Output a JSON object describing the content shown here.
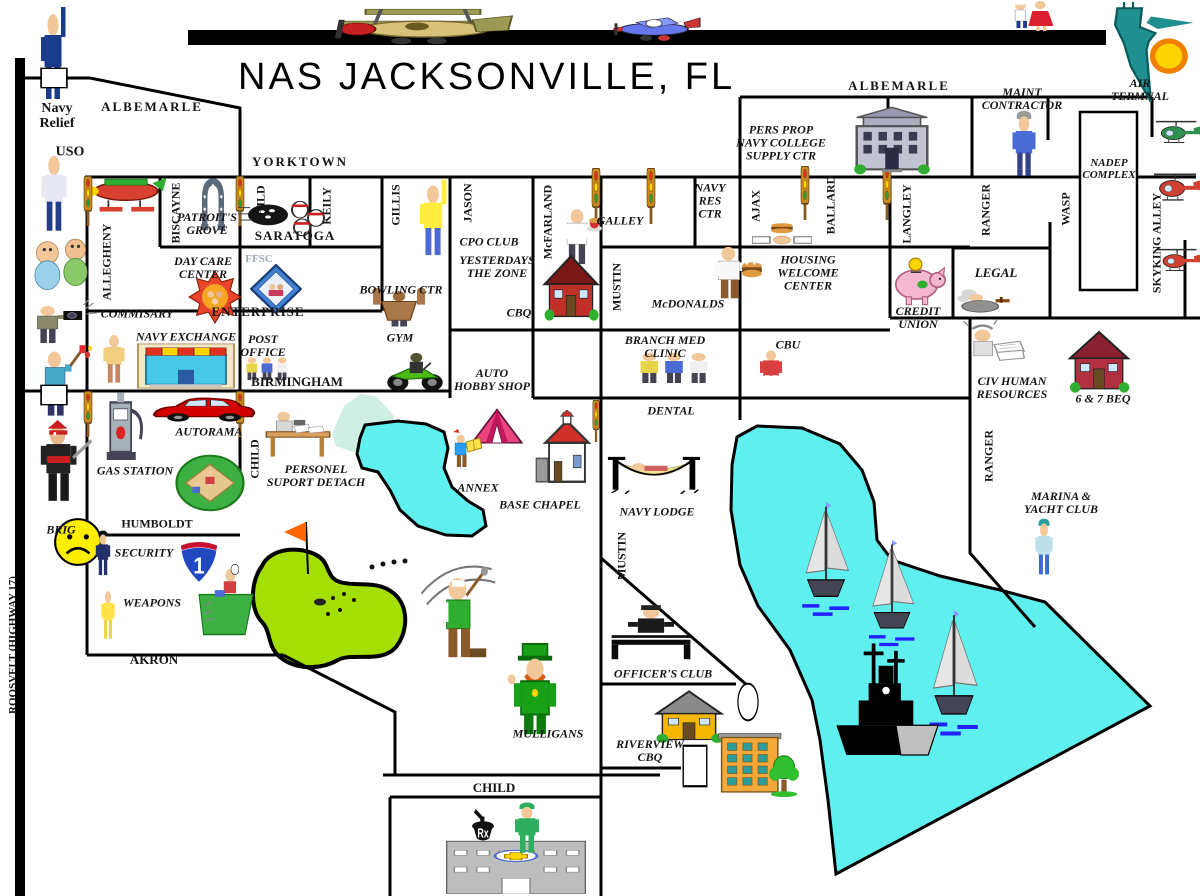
{
  "title": "NAS JACKSONVILLE, FL",
  "colors": {
    "water": "#5fefef",
    "water_sketch": "#cfeee4",
    "golf_green": "#a4de02",
    "flag": "#ff6600",
    "road": "#000000"
  },
  "interstate_shield": "1",
  "pharmacy_sign": "Rx",
  "labels": [
    {
      "id": "navy-relief",
      "t": "Navy\nRelief",
      "x": 57,
      "y": 116,
      "s": 14
    },
    {
      "id": "uso",
      "t": "USO",
      "x": 70,
      "y": 152,
      "s": 14
    },
    {
      "id": "albemarle-left",
      "t": "ALBEMARLE",
      "x": 152,
      "y": 107,
      "s": 13,
      "sp": 2
    },
    {
      "id": "yorktown",
      "t": "YORKTOWN",
      "x": 300,
      "y": 162,
      "s": 13,
      "sp": 2
    },
    {
      "id": "albemarle-right",
      "t": "ALBEMARLE",
      "x": 899,
      "y": 86,
      "s": 13,
      "sp": 2
    },
    {
      "id": "maint-contractor",
      "t": "MAINT\nCONTRACTOR",
      "x": 1022,
      "y": 99,
      "i": 1,
      "s": 12
    },
    {
      "id": "air-termnal",
      "t": "AIR TERMNAL",
      "x": 1140,
      "y": 90,
      "i": 1,
      "s": 12
    },
    {
      "id": "pers-prop",
      "t": "PERS PROP\nNAVY COLLEGE\nSUPPLY CTR",
      "x": 781,
      "y": 143,
      "i": 1,
      "s": 12
    },
    {
      "id": "navy-res-ctr",
      "t": "NAVY\nRES\nCTR",
      "x": 710,
      "y": 201,
      "i": 1,
      "s": 12
    },
    {
      "id": "nadep-complex",
      "t": "NADEP\nCOMPLEX",
      "x": 1109,
      "y": 170,
      "i": 1,
      "s": 11
    },
    {
      "id": "patriots-grove",
      "t": "PATROIT'S\nGROVE",
      "x": 207,
      "y": 224,
      "i": 1,
      "s": 12
    },
    {
      "id": "saratoga",
      "t": "SARATOGA",
      "x": 295,
      "y": 236,
      "s": 13,
      "sp": 1
    },
    {
      "id": "galley",
      "t": "GALLEY",
      "x": 620,
      "y": 221,
      "i": 1,
      "s": 12
    },
    {
      "id": "cpo-club",
      "t": "CPO CLUB",
      "x": 489,
      "y": 242,
      "i": 1,
      "s": 12
    },
    {
      "id": "yesterdays",
      "t": "YESTERDAYS\nTHE ZONE",
      "x": 497,
      "y": 267,
      "i": 1,
      "s": 12
    },
    {
      "id": "day-care",
      "t": "DAY CARE\nCENTER",
      "x": 203,
      "y": 268,
      "i": 1,
      "s": 12
    },
    {
      "id": "ffsc",
      "t": "FFSC",
      "x": 259,
      "y": 260,
      "s": 11,
      "c": "#9aa8b8"
    },
    {
      "id": "enterprise",
      "t": "ENTERPRISE",
      "x": 258,
      "y": 312,
      "s": 13,
      "sp": 1
    },
    {
      "id": "bowling-ctr",
      "t": "BOWLING CTR",
      "x": 401,
      "y": 290,
      "i": 1,
      "s": 12
    },
    {
      "id": "commisary",
      "t": "COMMISARY",
      "x": 137,
      "y": 314,
      "i": 1,
      "s": 12
    },
    {
      "id": "navy-exchange",
      "t": "NAVY EXCHANGE",
      "x": 186,
      "y": 337,
      "i": 1,
      "s": 12
    },
    {
      "id": "post-office",
      "t": "POST\nOFFICE",
      "x": 263,
      "y": 346,
      "i": 1,
      "s": 12
    },
    {
      "id": "birmingham",
      "t": "BIRMINGHAM",
      "x": 297,
      "y": 382,
      "s": 13
    },
    {
      "id": "gym",
      "t": "GYM",
      "x": 400,
      "y": 338,
      "i": 1,
      "s": 12
    },
    {
      "id": "auto-hobby",
      "t": "AUTO\nHOBBY SHOP",
      "x": 492,
      "y": 380,
      "i": 1,
      "s": 12
    },
    {
      "id": "cbq",
      "t": "CBQ",
      "x": 519,
      "y": 313,
      "i": 1,
      "s": 12
    },
    {
      "id": "mcdonalds",
      "t": "McDONALDS",
      "x": 688,
      "y": 304,
      "i": 1,
      "s": 12
    },
    {
      "id": "housing-welcome",
      "t": "HOUSING\nWELCOME\nCENTER",
      "x": 808,
      "y": 273,
      "i": 1,
      "s": 12
    },
    {
      "id": "credit-union",
      "t": "CREDIT\nUNION",
      "x": 918,
      "y": 318,
      "i": 1,
      "s": 12
    },
    {
      "id": "legal",
      "t": "LEGAL",
      "x": 996,
      "y": 273,
      "i": 1,
      "s": 13
    },
    {
      "id": "branch-med",
      "t": "BRANCH MED\nCLINIC",
      "x": 665,
      "y": 347,
      "i": 1,
      "s": 12
    },
    {
      "id": "cbu",
      "t": "CBU",
      "x": 788,
      "y": 345,
      "i": 1,
      "s": 12
    },
    {
      "id": "dental",
      "t": "DENTAL",
      "x": 671,
      "y": 411,
      "i": 1,
      "s": 12
    },
    {
      "id": "civ-hr",
      "t": "CIV  HUMAN\nRESOURCES",
      "x": 1012,
      "y": 388,
      "i": 1,
      "s": 12
    },
    {
      "id": "beq",
      "t": "6 & 7 BEQ",
      "x": 1103,
      "y": 399,
      "i": 1,
      "s": 12
    },
    {
      "id": "autorama",
      "t": "AUTORAMA",
      "x": 209,
      "y": 432,
      "i": 1,
      "s": 12
    },
    {
      "id": "gas-station",
      "t": "GAS STATION",
      "x": 135,
      "y": 471,
      "i": 1,
      "s": 12
    },
    {
      "id": "humboldt",
      "t": "HUMBOLDT",
      "x": 157,
      "y": 524,
      "s": 12
    },
    {
      "id": "brig",
      "t": "BRIG",
      "x": 61,
      "y": 530,
      "i": 1,
      "s": 12
    },
    {
      "id": "security",
      "t": "SECURITY",
      "x": 144,
      "y": 553,
      "i": 1,
      "s": 12
    },
    {
      "id": "weapons",
      "t": "WEAPONS",
      "x": 152,
      "y": 603,
      "i": 1,
      "s": 12
    },
    {
      "id": "akron",
      "t": "AKRON",
      "x": 154,
      "y": 660,
      "s": 13
    },
    {
      "id": "personel",
      "t": "PERSONEL\nSUPORT DETACH",
      "x": 316,
      "y": 476,
      "i": 1,
      "s": 12
    },
    {
      "id": "annex",
      "t": "ANNEX",
      "x": 478,
      "y": 488,
      "i": 1,
      "s": 12
    },
    {
      "id": "base-chapel",
      "t": "BASE CHAPEL",
      "x": 540,
      "y": 505,
      "i": 1,
      "s": 12
    },
    {
      "id": "navy-lodge",
      "t": "NAVY LODGE",
      "x": 657,
      "y": 512,
      "i": 1,
      "s": 12
    },
    {
      "id": "marina",
      "t": "MARINA &\nYACHT CLUB",
      "x": 1061,
      "y": 503,
      "i": 1,
      "s": 12
    },
    {
      "id": "officers-club",
      "t": "OFFICER'S CLUB",
      "x": 663,
      "y": 674,
      "i": 1,
      "s": 12
    },
    {
      "id": "mulligans",
      "t": "MULLIGANS",
      "x": 548,
      "y": 734,
      "i": 1,
      "s": 12
    },
    {
      "id": "riverview",
      "t": "RIVERVIEW\nCBQ",
      "x": 650,
      "y": 751,
      "i": 1,
      "s": 12
    },
    {
      "id": "child-bottom",
      "t": "CHILD",
      "x": 494,
      "y": 788,
      "s": 13
    },
    {
      "id": "allegheny",
      "t": "ALLEGHENY",
      "x": 107,
      "y": 262,
      "v": 1,
      "s": 12
    },
    {
      "id": "biscayne",
      "t": "BISCAYNE",
      "x": 176,
      "y": 213,
      "v": 1,
      "s": 12
    },
    {
      "id": "child-top",
      "t": "CHILD",
      "x": 261,
      "y": 205,
      "v": 1,
      "s": 12
    },
    {
      "id": "keily",
      "t": "KEILY",
      "x": 327,
      "y": 206,
      "v": 1,
      "s": 12
    },
    {
      "id": "gillis",
      "t": "GILLIS",
      "x": 396,
      "y": 205,
      "v": 1,
      "s": 12
    },
    {
      "id": "jason",
      "t": "JASON",
      "x": 468,
      "y": 203,
      "v": 1,
      "s": 12
    },
    {
      "id": "mcfarland",
      "t": "McFARLAND",
      "x": 548,
      "y": 222,
      "v": 1,
      "s": 12
    },
    {
      "id": "mustin-1",
      "t": "MUSTIN",
      "x": 617,
      "y": 287,
      "v": 1,
      "s": 12
    },
    {
      "id": "ajax",
      "t": "AJAX",
      "x": 756,
      "y": 206,
      "v": 1,
      "s": 12
    },
    {
      "id": "ballard",
      "t": "BALLARD",
      "x": 831,
      "y": 205,
      "v": 1,
      "s": 12
    },
    {
      "id": "langley",
      "t": "LANGLEY",
      "x": 907,
      "y": 214,
      "v": 1,
      "s": 12
    },
    {
      "id": "ranger-1",
      "t": "RANGER",
      "x": 986,
      "y": 210,
      "v": 1,
      "s": 12
    },
    {
      "id": "wasp",
      "t": "WASP",
      "x": 1066,
      "y": 209,
      "v": 1,
      "s": 12
    },
    {
      "id": "skyking-alley",
      "t": "SKYKING ALLEY",
      "x": 1157,
      "y": 243,
      "v": 1,
      "s": 12
    },
    {
      "id": "child-mid",
      "t": "CHILD",
      "x": 255,
      "y": 459,
      "v": 1,
      "s": 12
    },
    {
      "id": "mustin-2",
      "t": "MUSTIN",
      "x": 622,
      "y": 556,
      "v": 1,
      "s": 12
    },
    {
      "id": "ranger-2",
      "t": "RANGER",
      "x": 989,
      "y": 456,
      "v": 1,
      "s": 12
    },
    {
      "id": "roosevelt-hwy",
      "t": "ROOSVELT (HIGHWAY 17)",
      "x": 14,
      "y": 645,
      "v": 1,
      "s": 11
    }
  ],
  "icons": [
    {
      "id": "navy-officer",
      "k": "person",
      "x": 28,
      "y": 5,
      "w": 50,
      "h": 100,
      "o": {
        "shirt": "#1a3a8a",
        "pants": "#1a3a8a",
        "hat": "#ffffff",
        "arm": "up"
      }
    },
    {
      "id": "biplane",
      "k": "biplane",
      "x": 322,
      "y": 0,
      "w": 198,
      "h": 66
    },
    {
      "id": "blue-plane",
      "k": "monoplane",
      "x": 606,
      "y": 4,
      "w": 100,
      "h": 46
    },
    {
      "id": "sailor-couple",
      "k": "couple",
      "x": 998,
      "y": 0,
      "w": 66,
      "h": 50
    },
    {
      "id": "aircraft-carrier",
      "k": "carrier",
      "x": 1086,
      "y": 2,
      "w": 112,
      "h": 104
    },
    {
      "id": "uso-sailor",
      "k": "person",
      "x": 28,
      "y": 148,
      "w": 52,
      "h": 88,
      "o": {
        "shirt": "#e8e8f4",
        "pants": "#22408a",
        "hat": "#ffffff"
      }
    },
    {
      "id": "seaplane",
      "k": "seaplane",
      "x": 82,
      "y": 166,
      "w": 88,
      "h": 66
    },
    {
      "id": "babies",
      "k": "babies",
      "x": 24,
      "y": 224,
      "w": 78,
      "h": 80
    },
    {
      "id": "photographer",
      "k": "photographer",
      "x": 26,
      "y": 298,
      "w": 72,
      "h": 50
    },
    {
      "id": "painter",
      "k": "painter",
      "x": 28,
      "y": 342,
      "w": 66,
      "h": 80
    },
    {
      "id": "pirate",
      "k": "pirate",
      "x": 24,
      "y": 420,
      "w": 70,
      "h": 86
    },
    {
      "id": "brig-sad-face",
      "k": "sadface",
      "x": 52,
      "y": 516,
      "w": 52,
      "h": 52
    },
    {
      "id": "gate-north",
      "k": "gate",
      "x": 40,
      "y": 67,
      "w": 28,
      "h": 22
    },
    {
      "id": "gate-south",
      "k": "gate",
      "x": 40,
      "y": 384,
      "w": 28,
      "h": 22
    },
    {
      "id": "traffic-light-1",
      "k": "trafficlight",
      "x": 78,
      "y": 176,
      "w": 20,
      "h": 50
    },
    {
      "id": "traffic-light-2",
      "k": "trafficlight",
      "x": 230,
      "y": 176,
      "w": 20,
      "h": 50
    },
    {
      "id": "traffic-light-3",
      "k": "trafficlight",
      "x": 586,
      "y": 168,
      "w": 20,
      "h": 56
    },
    {
      "id": "traffic-light-4",
      "k": "trafficlight",
      "x": 641,
      "y": 168,
      "w": 20,
      "h": 56
    },
    {
      "id": "traffic-light-5",
      "k": "trafficlight",
      "x": 795,
      "y": 166,
      "w": 20,
      "h": 54
    },
    {
      "id": "traffic-light-6",
      "k": "trafficlight",
      "x": 877,
      "y": 166,
      "w": 20,
      "h": 54
    },
    {
      "id": "traffic-light-7",
      "k": "trafficlight",
      "x": 78,
      "y": 391,
      "w": 20,
      "h": 46
    },
    {
      "id": "traffic-light-8",
      "k": "trafficlight",
      "x": 230,
      "y": 391,
      "w": 20,
      "h": 46
    },
    {
      "id": "traffic-light-9",
      "k": "trafficlight",
      "x": 588,
      "y": 400,
      "w": 16,
      "h": 42
    },
    {
      "id": "horseshoe",
      "k": "horseshoe",
      "x": 190,
      "y": 172,
      "w": 46,
      "h": 62
    },
    {
      "id": "daycare-kids",
      "k": "starburst",
      "x": 188,
      "y": 270,
      "w": 54,
      "h": 54
    },
    {
      "id": "ffsc-sign",
      "k": "diamond",
      "x": 250,
      "y": 264,
      "w": 52,
      "h": 50
    },
    {
      "id": "commissary-shopper",
      "k": "person",
      "x": 92,
      "y": 330,
      "w": 44,
      "h": 56,
      "o": {
        "shirt": "#f0d080",
        "pants": "#c88660"
      }
    },
    {
      "id": "navy-exchange-store",
      "k": "store",
      "x": 136,
      "y": 342,
      "w": 100,
      "h": 48
    },
    {
      "id": "post-office-customers",
      "k": "docs",
      "x": 240,
      "y": 352,
      "w": 54,
      "h": 38
    },
    {
      "id": "bowling-ball-pins",
      "k": "bowling",
      "x": 238,
      "y": 192,
      "w": 100,
      "h": 52
    },
    {
      "id": "horseshoe-player",
      "k": "person",
      "x": 406,
      "y": 178,
      "w": 54,
      "h": 82,
      "o": {
        "shirt": "#ffec40",
        "pants": "#4a6ad4",
        "arm": "up"
      }
    },
    {
      "id": "gym-muscleman",
      "k": "muscleman",
      "x": 368,
      "y": 288,
      "w": 62,
      "h": 52
    },
    {
      "id": "motorcycle",
      "k": "motorcycle",
      "x": 382,
      "y": 344,
      "w": 66,
      "h": 52
    },
    {
      "id": "galley-chef",
      "k": "chef",
      "x": 548,
      "y": 202,
      "w": 58,
      "h": 66
    },
    {
      "id": "cbq-house",
      "k": "house",
      "x": 541,
      "y": 252,
      "w": 60,
      "h": 70,
      "o": {
        "body": "#c03028",
        "roof": "#7a1818"
      }
    },
    {
      "id": "mcdonalds-diner",
      "k": "eater",
      "x": 706,
      "y": 240,
      "w": 62,
      "h": 62
    },
    {
      "id": "welcome-handshake",
      "k": "handshake",
      "x": 752,
      "y": 220,
      "w": 60,
      "h": 40
    },
    {
      "id": "credit-union-piggy",
      "k": "piggy",
      "x": 890,
      "y": 252,
      "w": 58,
      "h": 56
    },
    {
      "id": "legal-judge",
      "k": "judge",
      "x": 948,
      "y": 284,
      "w": 70,
      "h": 36
    },
    {
      "id": "hr-thinker",
      "k": "thinker",
      "x": 958,
      "y": 320,
      "w": 72,
      "h": 56
    },
    {
      "id": "beq-house",
      "k": "house",
      "x": 1066,
      "y": 328,
      "w": 66,
      "h": 66,
      "o": {
        "body": "#b03040",
        "roof": "#8a2030"
      }
    },
    {
      "id": "college-building",
      "k": "college",
      "x": 850,
      "y": 106,
      "w": 84,
      "h": 72
    },
    {
      "id": "maint-worker",
      "k": "person",
      "x": 1000,
      "y": 110,
      "w": 48,
      "h": 70,
      "o": {
        "shirt": "#4a6ad4",
        "pants": "#33408a",
        "hat": "#999999"
      }
    },
    {
      "id": "helicopter-1",
      "k": "heli",
      "x": 1154,
      "y": 118,
      "w": 46,
      "h": 36,
      "o": {
        "c": "#2f8f4f"
      }
    },
    {
      "id": "helicopter-2",
      "k": "heli",
      "x": 1152,
      "y": 170,
      "w": 48,
      "h": 44,
      "o": {
        "c": "#d04030"
      }
    },
    {
      "id": "helicopter-3",
      "k": "heli",
      "x": 1156,
      "y": 246,
      "w": 44,
      "h": 36,
      "o": {
        "c": "#d04030"
      }
    },
    {
      "id": "autorama-car",
      "k": "car",
      "x": 150,
      "y": 388,
      "w": 108,
      "h": 42
    },
    {
      "id": "gas-pump",
      "k": "gaspump",
      "x": 94,
      "y": 388,
      "w": 58,
      "h": 80
    },
    {
      "id": "ballfield",
      "k": "ballfield",
      "x": 172,
      "y": 452,
      "w": 76,
      "h": 62
    },
    {
      "id": "security-policeman",
      "k": "person",
      "x": 88,
      "y": 530,
      "w": 30,
      "h": 48,
      "o": {
        "shirt": "#22306a",
        "pants": "#22306a",
        "hat": "#111111"
      }
    },
    {
      "id": "weapons-guard",
      "k": "person",
      "x": 94,
      "y": 586,
      "w": 28,
      "h": 56,
      "o": {
        "shirt": "#ffe24a",
        "pants": "#e8d44a"
      }
    },
    {
      "id": "interstate-shield",
      "k": "shield",
      "x": 176,
      "y": 534,
      "w": 46,
      "h": 52,
      "t": "1"
    },
    {
      "id": "ballfield-slider",
      "k": "slider",
      "x": 198,
      "y": 562,
      "w": 56,
      "h": 74
    },
    {
      "id": "personnel-clerk",
      "k": "desk",
      "x": 262,
      "y": 408,
      "w": 72,
      "h": 54
    },
    {
      "id": "annex-tent",
      "k": "tent",
      "x": 466,
      "y": 406,
      "w": 62,
      "h": 46
    },
    {
      "id": "annex-camper",
      "k": "reader",
      "x": 444,
      "y": 428,
      "w": 46,
      "h": 50
    },
    {
      "id": "chapel-church",
      "k": "church",
      "x": 535,
      "y": 410,
      "w": 64,
      "h": 78
    },
    {
      "id": "lodge-hammock",
      "k": "hammock",
      "x": 606,
      "y": 446,
      "w": 96,
      "h": 52
    },
    {
      "id": "sailboat-1",
      "k": "sailboat",
      "x": 793,
      "y": 502,
      "w": 66,
      "h": 118
    },
    {
      "id": "sailboat-2",
      "k": "sailboat",
      "x": 860,
      "y": 540,
      "w": 64,
      "h": 110
    },
    {
      "id": "sailboat-3",
      "k": "sailboat",
      "x": 920,
      "y": 610,
      "w": 68,
      "h": 130
    },
    {
      "id": "battleship",
      "k": "battleship",
      "x": 824,
      "y": 636,
      "w": 124,
      "h": 124
    },
    {
      "id": "golfer",
      "k": "golfer",
      "x": 416,
      "y": 556,
      "w": 90,
      "h": 110
    },
    {
      "id": "mulligans-leprechaun",
      "k": "leprechaun",
      "x": 496,
      "y": 642,
      "w": 78,
      "h": 98
    },
    {
      "id": "club-pianist",
      "k": "piano",
      "x": 610,
      "y": 604,
      "w": 82,
      "h": 60
    },
    {
      "id": "riverview-house",
      "k": "house",
      "x": 652,
      "y": 688,
      "w": 74,
      "h": 56,
      "o": {
        "body": "#f5b700",
        "roof": "#8a8a8a"
      }
    },
    {
      "id": "pond-oval",
      "k": "oval",
      "x": 736,
      "y": 682,
      "w": 24,
      "h": 40
    },
    {
      "id": "pond-rect",
      "k": "rectwhite",
      "x": 681,
      "y": 744,
      "w": 28,
      "h": 44
    },
    {
      "id": "apartment-building",
      "k": "apartment",
      "x": 714,
      "y": 728,
      "w": 76,
      "h": 68
    },
    {
      "id": "tree",
      "k": "tree",
      "x": 762,
      "y": 750,
      "w": 44,
      "h": 48
    },
    {
      "id": "hospital-building",
      "k": "hospital",
      "x": 446,
      "y": 838,
      "w": 140,
      "h": 56
    },
    {
      "id": "pharmacy-mortar",
      "k": "rx",
      "x": 466,
      "y": 804,
      "w": 34,
      "h": 48,
      "t": "Rx"
    },
    {
      "id": "surgeon",
      "k": "person",
      "x": 502,
      "y": 802,
      "w": 50,
      "h": 54,
      "o": {
        "shirt": "#2fae60",
        "pants": "#2fae60",
        "hat": "#2fae60"
      }
    },
    {
      "id": "marina-sailor",
      "k": "person",
      "x": 1026,
      "y": 518,
      "w": 36,
      "h": 60,
      "o": {
        "shirt": "#bfe0e8",
        "pants": "#3a6ad4",
        "hat": "#2a9d9d"
      }
    },
    {
      "id": "cbu-cheerleader",
      "k": "person",
      "x": 748,
      "y": 346,
      "w": 46,
      "h": 48,
      "o": {
        "shirt": "#d84040",
        "pants": "#ffffff"
      }
    },
    {
      "id": "clinic-staff",
      "k": "docs",
      "x": 630,
      "y": 346,
      "w": 88,
      "h": 50
    }
  ]
}
